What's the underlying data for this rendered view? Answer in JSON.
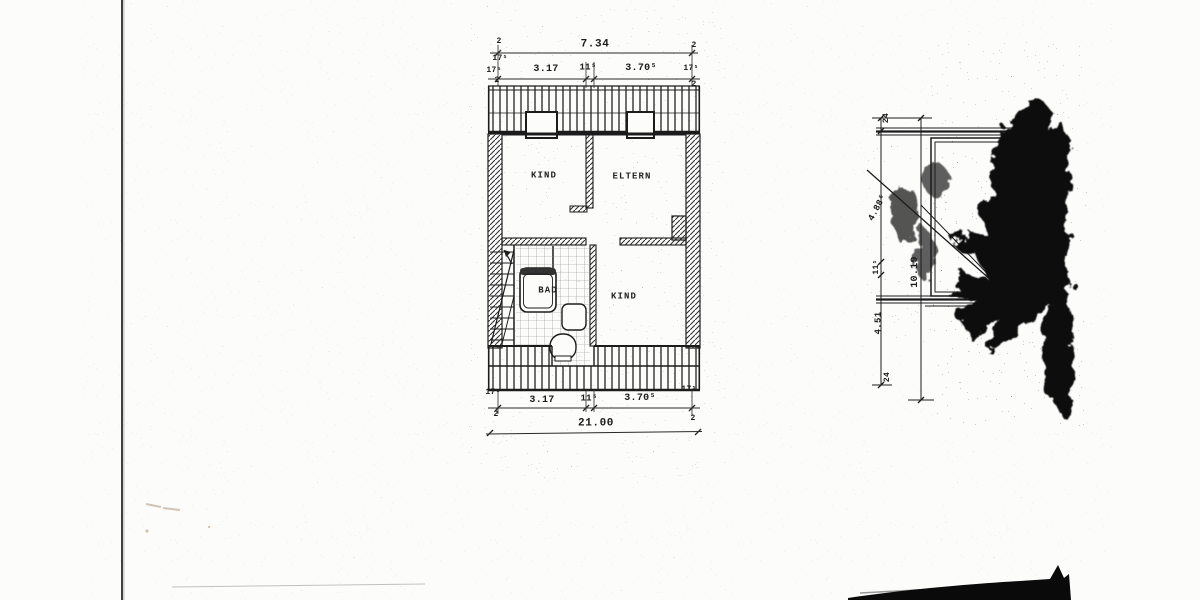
{
  "colors": {
    "ink": "#1b1b1b",
    "paper": "#fcfcfb"
  },
  "floor_plan": {
    "rooms": {
      "kind_top": "KIND",
      "eltern": "ELTERN",
      "kind_bottom": "KIND",
      "bad": "BAD"
    },
    "dim_top": {
      "total": "7.34",
      "tick_left": "2",
      "tick_right": "2",
      "seg_left": "3.17",
      "seg_mid": "11⁵",
      "seg_right": "3.70⁵",
      "edge_left_a": "17⁵",
      "edge_left_b": "17⁵",
      "edge_left_c": "2",
      "edge_right_a": "17⁵",
      "edge_right_b": "2"
    },
    "dim_bottom": {
      "seg_left": "3.17",
      "seg_mid": "11⁵",
      "seg_right": "3.70⁵",
      "edge_left_a": "17⁵",
      "edge_left_b": "2",
      "edge_right_a": "17⁵",
      "edge_right_b": "2",
      "total": "21.00"
    }
  },
  "side_diagram": {
    "dim": {
      "tick_top": "24",
      "seg_upper": "4.88⁵",
      "seg_mid": "11⁵",
      "total": "10.19",
      "seg_lower": "4.51",
      "tick_bottom": "24"
    }
  }
}
